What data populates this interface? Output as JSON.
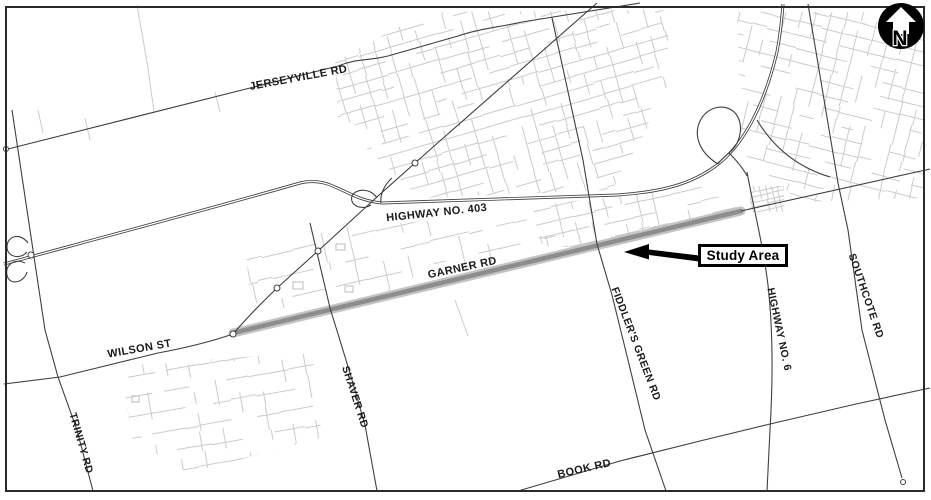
{
  "map": {
    "figure_type": "study-area-location-map",
    "study_area": {
      "label": "Study Area"
    },
    "north_arrow": {
      "letter": "N"
    },
    "colors": {
      "frame": "#2a2a2a",
      "road": "#3f3f3f",
      "residential": "#cbcbcb",
      "study_band_core": "#8d8d8d",
      "study_band_halo": "#c3c3c3",
      "label_text": "#1b1b1b"
    },
    "road_labels": [
      {
        "id": "jerseyville-rd",
        "text": "JERSEYVILLE RD",
        "x": 299,
        "y": 81,
        "rotate": -10.5,
        "size": 11
      },
      {
        "id": "highway-403",
        "text": "HIGHWAY NO. 403",
        "x": 437,
        "y": 216,
        "rotate": -6,
        "size": 11
      },
      {
        "id": "garner-rd",
        "text": "GARNER RD",
        "x": 463,
        "y": 271,
        "rotate": -12,
        "size": 11
      },
      {
        "id": "wilson-st",
        "text": "WILSON ST",
        "x": 140,
        "y": 352,
        "rotate": -10,
        "size": 11
      },
      {
        "id": "trinity-rd",
        "text": "TRINITY RD",
        "x": 78,
        "y": 444,
        "rotate": 74,
        "size": 10.5
      },
      {
        "id": "shaver-rd",
        "text": "SHAVER RD",
        "x": 352,
        "y": 398,
        "rotate": 72,
        "size": 10.5
      },
      {
        "id": "book-rd",
        "text": "BOOK RD",
        "x": 585,
        "y": 472,
        "rotate": -13,
        "size": 11
      },
      {
        "id": "fiddlers-green-rd",
        "text": "FIDDLER'S GREEN RD",
        "x": 633,
        "y": 345,
        "rotate": 69,
        "size": 10.5
      },
      {
        "id": "highway-6",
        "text": "HIGHWAY NO. 6",
        "x": 776,
        "y": 330,
        "rotate": 78,
        "size": 10.5
      },
      {
        "id": "southcote-rd",
        "text": "SOUTHCOTE RD",
        "x": 863,
        "y": 297,
        "rotate": 71,
        "size": 10.5
      }
    ]
  }
}
